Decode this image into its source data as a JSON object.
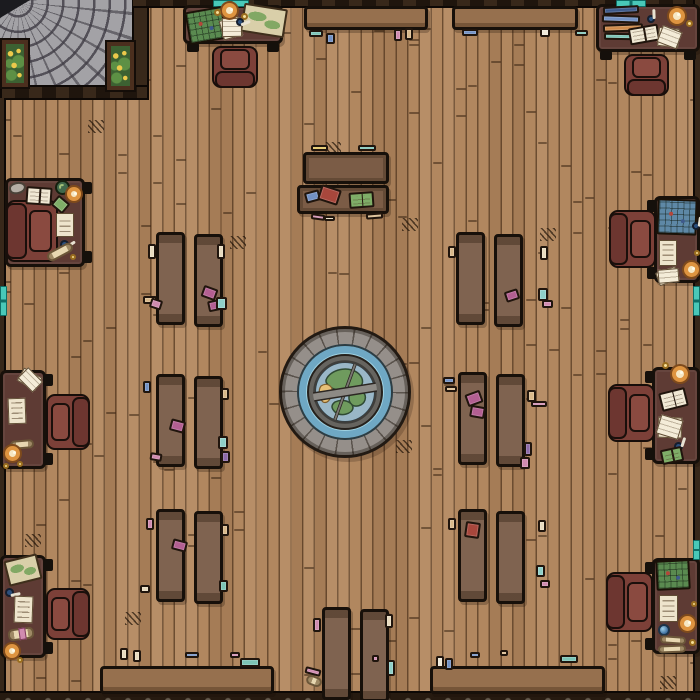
{
  "map": {
    "kind": "top-down battle map",
    "scene": "wooden-floor study hall with central globe fountain",
    "grid_px": 58,
    "size": {
      "w": 700,
      "h": 700
    }
  },
  "palette": {
    "floor": "#b1875f",
    "floor_line": "#54371d",
    "wall": "#261a10",
    "wall_light": "#59422c",
    "outline": "#17100a",
    "cobble": "#a3a2a6",
    "cobble_line": "#3f3c44",
    "planter_frame": "#4b2f1e",
    "plant": "#3c6132",
    "plant_light": "#5d9045",
    "flower": "#ecc94b",
    "teacher_desk": "#5e3b34",
    "student_table": "#7f6350",
    "bench": "#96704e",
    "demo_table": "#7b5c46",
    "chair": "#7c4038",
    "chair_dark": "#6d3630",
    "chair_seat": "#8a4a40",
    "fountain_stone": "#8d8781",
    "water": "#a0d2e2",
    "water_rim": "#6fa8c4",
    "globe_ring": "#66645f",
    "globe_ocean": "#9ab7c7",
    "globe_land": "#6f9b5e",
    "globe_sand": "#e6c077",
    "globe_bar": "#8d8a85",
    "window": "#49c8b8",
    "window_dark": "#0f6e66",
    "paper": "#eee4cc",
    "scroll": "#e7d7b1",
    "candle_wax": "#f6e7c4",
    "candle_ring": "#de9440",
    "coin": "#ecc258",
    "ink": "#2c4f7c",
    "books": {
      "pink": "#d08bb0",
      "magenta": "#b35f92",
      "purple": "#8d6aa8",
      "blue": "#7291c4",
      "navy": "#3e5a8c",
      "teal": "#7cc4b6",
      "cyan": "#8fd0c8",
      "green": "#7fae68",
      "red": "#a8473c",
      "orange": "#cf8a4a",
      "tan": "#d9b98a",
      "beige": "#e9dcc0",
      "white": "#efe9da",
      "yellow": "#e3c45c"
    }
  },
  "objects": {
    "courtyard": {
      "cobble": [
        0,
        0,
        132,
        85
      ],
      "wall_right": [
        132,
        0,
        17,
        100
      ],
      "wall_bottom": [
        0,
        85,
        149,
        15
      ],
      "corner": [
        0,
        0,
        30,
        18
      ],
      "planters": [
        [
          2,
          40,
          26,
          47
        ],
        [
          107,
          42,
          27,
          48
        ]
      ]
    },
    "walls": {
      "top": [
        133,
        0,
        567,
        8
      ],
      "left": [
        0,
        98,
        6,
        602
      ],
      "right": [
        693,
        0,
        7,
        700
      ],
      "bottom": [
        0,
        691,
        700,
        9
      ]
    },
    "windows": [
      [
        "top",
        213,
        0,
        36,
        7
      ],
      [
        "top",
        616,
        0,
        30,
        7
      ],
      [
        "left",
        0,
        286,
        7,
        30
      ],
      [
        "right",
        693,
        286,
        7,
        30
      ],
      [
        "right",
        693,
        540,
        7,
        20
      ]
    ],
    "benches": [
      [
        304,
        6,
        124,
        24
      ],
      [
        452,
        6,
        126,
        24
      ],
      [
        100,
        666,
        174,
        28
      ],
      [
        430,
        666,
        175,
        28
      ]
    ],
    "demo_tables": [
      [
        303,
        152,
        86,
        32
      ],
      [
        297,
        185,
        92,
        29
      ]
    ],
    "student_pairs": [
      [
        156,
        232
      ],
      [
        156,
        374
      ],
      [
        156,
        509
      ],
      [
        456,
        232
      ],
      [
        458,
        372
      ],
      [
        458,
        509
      ],
      [
        322,
        607
      ]
    ],
    "pair_size": {
      "w": 29,
      "gap": 9,
      "h": 93
    },
    "teacher_desks": [
      {
        "rect": [
          183,
          5,
          100,
          39
        ],
        "feet": "b"
      },
      {
        "rect": [
          596,
          4,
          104,
          48
        ],
        "feet": "b"
      },
      {
        "rect": [
          5,
          178,
          80,
          89
        ],
        "feet": "r"
      },
      {
        "rect": [
          0,
          370,
          46,
          99
        ],
        "feet": "r"
      },
      {
        "rect": [
          0,
          555,
          46,
          103
        ],
        "feet": "r"
      },
      {
        "rect": [
          654,
          196,
          46,
          87
        ],
        "feet": "l"
      },
      {
        "rect": [
          652,
          367,
          48,
          97
        ],
        "feet": "l"
      },
      {
        "rect": [
          652,
          558,
          48,
          96
        ],
        "feet": "l"
      }
    ],
    "chairs": [
      [
        212,
        46,
        46,
        42,
        "b"
      ],
      [
        624,
        54,
        45,
        42,
        "b"
      ],
      [
        6,
        200,
        52,
        62,
        "l"
      ],
      [
        46,
        394,
        44,
        56,
        "r"
      ],
      [
        46,
        588,
        44,
        52,
        "r"
      ],
      [
        609,
        210,
        47,
        58,
        "l"
      ],
      [
        608,
        384,
        47,
        58,
        "l"
      ],
      [
        606,
        572,
        47,
        60,
        "l"
      ]
    ],
    "fountain": {
      "x": 279,
      "y": 326,
      "d": 132,
      "water": [
        297,
        344,
        96,
        96
      ],
      "ring": [
        307,
        354,
        76,
        76
      ],
      "globe": [
        313,
        360,
        64,
        64
      ]
    },
    "hatches": [
      [
        230,
        236
      ],
      [
        402,
        218
      ],
      [
        396,
        440
      ],
      [
        25,
        534
      ],
      [
        125,
        612
      ],
      [
        540,
        228
      ],
      [
        325,
        142
      ],
      [
        660,
        676
      ],
      [
        88,
        120
      ]
    ],
    "items": [
      [
        "grid",
        187,
        9,
        38,
        33,
        -10,
        "green"
      ],
      [
        "map",
        242,
        6,
        44,
        29,
        9
      ],
      [
        "papers",
        220,
        17,
        23,
        22,
        -8
      ],
      [
        "candle",
        222,
        3,
        15,
        15
      ],
      [
        "coin",
        214,
        9,
        7,
        7
      ],
      [
        "coin",
        241,
        13,
        7,
        7
      ],
      [
        "ink",
        236,
        18,
        8,
        8,
        30
      ],
      [
        "book",
        603,
        6,
        36,
        8,
        -3,
        "navy"
      ],
      [
        "book",
        602,
        15,
        38,
        8,
        2,
        "blue"
      ],
      [
        "book",
        603,
        24,
        40,
        8,
        -2,
        "orange"
      ],
      [
        "book",
        604,
        33,
        34,
        7,
        1,
        "teal"
      ],
      [
        "openbook",
        629,
        26,
        30,
        17,
        -10
      ],
      [
        "papers",
        657,
        27,
        24,
        21,
        14
      ],
      [
        "candle",
        669,
        8,
        16,
        16
      ],
      [
        "coin",
        686,
        20,
        7,
        7
      ],
      [
        "ink",
        647,
        15,
        8,
        8,
        -40
      ],
      [
        "stone",
        9,
        182,
        17,
        12,
        -15
      ],
      [
        "jar",
        55,
        180,
        15,
        15
      ],
      [
        "openbook",
        26,
        187,
        26,
        18,
        4
      ],
      [
        "book",
        53,
        198,
        15,
        13,
        40,
        "green"
      ],
      [
        "candle",
        67,
        187,
        14,
        14
      ],
      [
        "paperlined",
        56,
        213,
        18,
        24,
        0
      ],
      [
        "ink",
        60,
        240,
        9,
        9,
        20
      ],
      [
        "scroll",
        46,
        247,
        28,
        10,
        -28
      ],
      [
        "coin",
        70,
        254,
        6,
        6
      ],
      [
        "papers",
        18,
        371,
        24,
        17,
        38
      ],
      [
        "paperlined",
        8,
        398,
        18,
        26,
        -2
      ],
      [
        "scroll",
        10,
        440,
        24,
        9,
        -5
      ],
      [
        "candle",
        5,
        446,
        15,
        15
      ],
      [
        "coin",
        17,
        461,
        6,
        6
      ],
      [
        "coin",
        3,
        463,
        6,
        6
      ],
      [
        "map",
        6,
        557,
        34,
        26,
        -14
      ],
      [
        "ink",
        5,
        588,
        9,
        9,
        40
      ],
      [
        "paperlined",
        14,
        596,
        19,
        27,
        2
      ],
      [
        "scrollbow",
        8,
        628,
        26,
        12,
        -8
      ],
      [
        "candle",
        5,
        644,
        14,
        14
      ],
      [
        "coin",
        17,
        657,
        6,
        6
      ],
      [
        "grid",
        657,
        199,
        40,
        36,
        2,
        "blue"
      ],
      [
        "paperlined",
        659,
        240,
        18,
        26,
        0
      ],
      [
        "papers",
        656,
        268,
        24,
        16,
        -12
      ],
      [
        "candle",
        684,
        262,
        15,
        15
      ],
      [
        "coin",
        694,
        250,
        6,
        6
      ],
      [
        "ink",
        692,
        222,
        8,
        8,
        -30
      ],
      [
        "coin",
        662,
        362,
        7,
        7
      ],
      [
        "candle",
        672,
        366,
        16,
        16
      ],
      [
        "openbook",
        660,
        390,
        27,
        19,
        -14
      ],
      [
        "papers",
        656,
        416,
        27,
        23,
        10
      ],
      [
        "ink",
        674,
        442,
        9,
        9,
        -20
      ],
      [
        "openbook",
        661,
        448,
        22,
        15,
        -12,
        "green"
      ],
      [
        "grid",
        656,
        560,
        34,
        30,
        -3,
        "green"
      ],
      [
        "paperlined",
        659,
        595,
        19,
        27,
        0
      ],
      [
        "orb",
        658,
        624,
        12,
        12
      ],
      [
        "candle",
        680,
        616,
        15,
        15
      ],
      [
        "coin",
        691,
        601,
        6,
        6
      ],
      [
        "coin",
        689,
        639,
        7,
        7
      ],
      [
        "scroll",
        660,
        636,
        26,
        8,
        4
      ],
      [
        "scroll",
        658,
        645,
        28,
        8,
        -2
      ],
      [
        "book",
        311,
        145,
        17,
        6,
        0,
        "yellow"
      ],
      [
        "book",
        358,
        145,
        18,
        6,
        0,
        "teal"
      ],
      [
        "book",
        305,
        191,
        15,
        11,
        -15,
        "blue"
      ],
      [
        "book",
        319,
        187,
        21,
        16,
        18,
        "red"
      ],
      [
        "openbook",
        349,
        192,
        25,
        16,
        -4,
        "green"
      ],
      [
        "book",
        311,
        214,
        14,
        6,
        8,
        "pink"
      ],
      [
        "book",
        324,
        216,
        11,
        5,
        0,
        "beige"
      ],
      [
        "book",
        366,
        213,
        17,
        6,
        -4,
        "tan"
      ],
      [
        "book",
        309,
        30,
        14,
        7,
        0,
        "teal"
      ],
      [
        "book",
        326,
        33,
        9,
        11,
        0,
        "blue"
      ],
      [
        "book",
        394,
        29,
        8,
        12,
        0,
        "pink"
      ],
      [
        "book",
        405,
        28,
        8,
        12,
        0,
        "tan"
      ],
      [
        "book",
        462,
        29,
        16,
        7,
        0,
        "blue"
      ],
      [
        "book",
        540,
        28,
        10,
        9,
        0,
        "white"
      ],
      [
        "book",
        575,
        30,
        13,
        6,
        0,
        "teal"
      ],
      [
        "book",
        148,
        244,
        8,
        15,
        0,
        "beige"
      ],
      [
        "book",
        217,
        244,
        8,
        15,
        0,
        "beige"
      ],
      [
        "book",
        143,
        296,
        14,
        8,
        0,
        "tan"
      ],
      [
        "book",
        150,
        299,
        12,
        10,
        18,
        "pink"
      ],
      [
        "book",
        202,
        287,
        15,
        12,
        20,
        "magenta"
      ],
      [
        "book",
        208,
        300,
        14,
        11,
        -12,
        "magenta"
      ],
      [
        "book",
        216,
        297,
        11,
        13,
        0,
        "cyan"
      ],
      [
        "book",
        143,
        381,
        8,
        12,
        0,
        "blue"
      ],
      [
        "book",
        221,
        388,
        8,
        12,
        0,
        "tan"
      ],
      [
        "book",
        170,
        420,
        15,
        12,
        15,
        "magenta"
      ],
      [
        "book",
        218,
        436,
        10,
        13,
        0,
        "cyan"
      ],
      [
        "book",
        150,
        453,
        12,
        8,
        10,
        "pink"
      ],
      [
        "book",
        221,
        451,
        9,
        12,
        0,
        "purple"
      ],
      [
        "book",
        146,
        518,
        8,
        12,
        0,
        "pink"
      ],
      [
        "book",
        221,
        524,
        8,
        12,
        0,
        "tan"
      ],
      [
        "book",
        172,
        540,
        15,
        11,
        15,
        "magenta"
      ],
      [
        "book",
        140,
        585,
        10,
        8,
        0,
        "beige"
      ],
      [
        "book",
        219,
        580,
        9,
        12,
        0,
        "teal"
      ],
      [
        "book",
        448,
        246,
        8,
        12,
        0,
        "tan"
      ],
      [
        "book",
        540,
        246,
        8,
        14,
        0,
        "beige"
      ],
      [
        "book",
        538,
        288,
        10,
        13,
        0,
        "cyan"
      ],
      [
        "book",
        542,
        300,
        11,
        8,
        0,
        "pink"
      ],
      [
        "book",
        505,
        290,
        14,
        11,
        -18,
        "magenta"
      ],
      [
        "book",
        443,
        377,
        12,
        7,
        0,
        "blue"
      ],
      [
        "book",
        445,
        386,
        12,
        6,
        0,
        "tan"
      ],
      [
        "book",
        466,
        392,
        16,
        13,
        -20,
        "magenta"
      ],
      [
        "book",
        470,
        406,
        15,
        12,
        10,
        "magenta"
      ],
      [
        "book",
        527,
        390,
        9,
        12,
        0,
        "tan"
      ],
      [
        "book",
        531,
        401,
        16,
        6,
        0,
        "pink"
      ],
      [
        "book",
        524,
        442,
        8,
        14,
        0,
        "purple"
      ],
      [
        "book",
        520,
        457,
        10,
        12,
        0,
        "pink"
      ],
      [
        "book",
        448,
        518,
        8,
        12,
        0,
        "tan"
      ],
      [
        "book",
        538,
        520,
        8,
        12,
        0,
        "beige"
      ],
      [
        "book",
        465,
        522,
        15,
        16,
        8,
        "red"
      ],
      [
        "book",
        536,
        565,
        9,
        12,
        0,
        "cyan"
      ],
      [
        "book",
        540,
        580,
        10,
        8,
        0,
        "pink"
      ],
      [
        "book",
        240,
        658,
        20,
        9,
        0,
        "teal"
      ],
      [
        "book",
        120,
        648,
        8,
        12,
        0,
        "beige"
      ],
      [
        "book",
        133,
        650,
        8,
        12,
        0,
        "beige"
      ],
      [
        "book",
        185,
        652,
        14,
        6,
        0,
        "blue"
      ],
      [
        "book",
        230,
        652,
        10,
        6,
        0,
        "pink"
      ],
      [
        "book",
        313,
        618,
        8,
        14,
        0,
        "pink"
      ],
      [
        "book",
        385,
        614,
        8,
        14,
        0,
        "beige"
      ],
      [
        "book",
        387,
        660,
        8,
        16,
        0,
        "cyan"
      ],
      [
        "book",
        372,
        655,
        7,
        7,
        0,
        "pink"
      ],
      [
        "book",
        305,
        668,
        16,
        7,
        15,
        "pink"
      ],
      [
        "scroll",
        306,
        676,
        16,
        10,
        20
      ],
      [
        "book",
        436,
        656,
        8,
        12,
        0,
        "white"
      ],
      [
        "book",
        445,
        658,
        8,
        12,
        0,
        "blue"
      ],
      [
        "book",
        470,
        652,
        10,
        6,
        0,
        "blue"
      ],
      [
        "book",
        500,
        650,
        8,
        6,
        0,
        "tan"
      ],
      [
        "book",
        560,
        655,
        18,
        8,
        0,
        "teal"
      ]
    ]
  }
}
